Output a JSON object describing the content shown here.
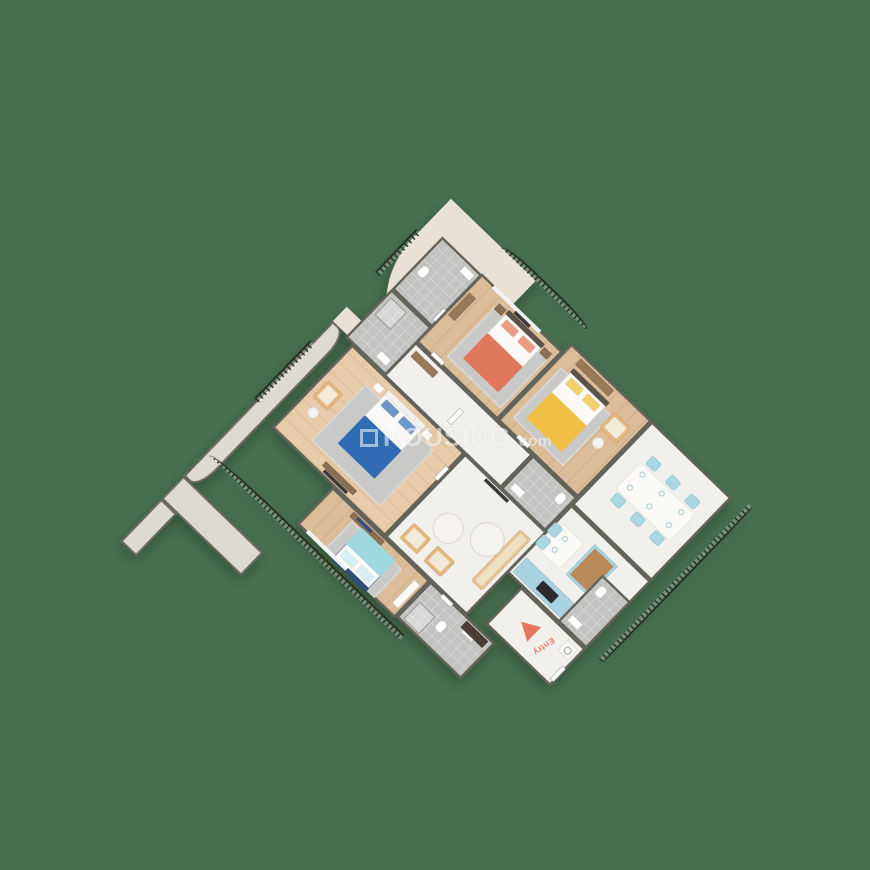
{
  "scene": {
    "type": "3d-isometric-apartment-floor-plan",
    "background_color": "#48714F",
    "watermark": {
      "brand": "HOUSING",
      "suffix": ".com",
      "color": "rgba(255,255,255,0.55)"
    },
    "entry": {
      "label": "Entry",
      "color": "#E4765D",
      "direction": "arrow-points-into-apartment-from-southeast"
    },
    "palette": {
      "wall_cap": "#63635A",
      "wood_floor": "#DCBD9A",
      "marble_floor": "#F2F0EC",
      "bathroom_tile": "#C2C2C0",
      "terrace_floor": "#E9E1D4",
      "railing_iron": "#26321F",
      "bed_coral": "#E0785E",
      "bed_yellow": "#EFC044",
      "bed_blue": "#2F6CB3",
      "bed_teal": "#9FD9DF",
      "chair_blue": "#A9D7E2",
      "kitchen_cabinet": "#A9D3E0",
      "sofa_tan": "#E6C394"
    },
    "rooms": [
      {
        "id": "balcony-top",
        "kind": "balcony",
        "features": [
          "curved-iron-railing"
        ]
      },
      {
        "id": "balcony-left",
        "kind": "balcony",
        "features": [
          "iron-railing"
        ]
      },
      {
        "id": "bedroom-coral",
        "kind": "bedroom",
        "floor": "wood",
        "furniture": [
          "double-bed-coral",
          "gray-rug",
          "nightstands",
          "wall-mirror-panel",
          "dresser"
        ]
      },
      {
        "id": "bathroom-1",
        "kind": "bathroom",
        "floor": "tile",
        "furniture": [
          "toilet",
          "sink"
        ]
      },
      {
        "id": "shower-room",
        "kind": "bathroom",
        "floor": "tile",
        "furniture": [
          "shower"
        ]
      },
      {
        "id": "bedroom-yellow",
        "kind": "bedroom",
        "floor": "wood",
        "furniture": [
          "double-bed-yellow",
          "gray-rug",
          "tan-armchair",
          "wardrobe"
        ]
      },
      {
        "id": "bathroom-2",
        "kind": "bathroom",
        "floor": "tile",
        "furniture": [
          "toilet",
          "sink"
        ]
      },
      {
        "id": "hallway",
        "kind": "corridor",
        "floor": "marble"
      },
      {
        "id": "bedroom-blue",
        "kind": "bedroom",
        "floor": "wood",
        "furniture": [
          "double-bed-blue",
          "gray-rug",
          "nightstands",
          "tan-armchair",
          "tv-unit"
        ]
      },
      {
        "id": "living-room",
        "kind": "living",
        "floor": "marble",
        "furniture": [
          "tan-sofa",
          "two-tan-armchairs",
          "two-round-coffee-tables",
          "tv"
        ]
      },
      {
        "id": "dining-room",
        "kind": "dining",
        "floor": "marble",
        "furniture": [
          "dining-table",
          "six-blue-chairs",
          "plates"
        ]
      },
      {
        "id": "kitchen",
        "kind": "kitchen",
        "floor": "marble",
        "furniture": [
          "blue-island-wood-top",
          "blue-counter-with-stove",
          "breakfast-table-two-blue-chairs"
        ]
      },
      {
        "id": "bathroom-3",
        "kind": "bathroom",
        "floor": "tile",
        "furniture": [
          "toilet",
          "sink"
        ]
      },
      {
        "id": "entry-foyer",
        "kind": "entry",
        "floor": "marble",
        "furniture": [
          "washing-machine",
          "entry-arrow"
        ]
      },
      {
        "id": "bedroom-teal",
        "kind": "bedroom",
        "floor": "wood",
        "furniture": [
          "double-bed-teal-navy-frame",
          "gray-rug",
          "tv-console-blue-decor",
          "wardrobe"
        ]
      },
      {
        "id": "bathroom-4",
        "kind": "bathroom",
        "floor": "tile",
        "furniture": [
          "toilet",
          "sink",
          "dark-wardrobe"
        ]
      },
      {
        "id": "terrace",
        "kind": "terrace",
        "floor": "beige-marble",
        "features": [
          "large-curved-iron-railing"
        ]
      },
      {
        "id": "balcony-right",
        "kind": "balcony",
        "features": [
          "long-curved-iron-railing"
        ]
      }
    ]
  }
}
